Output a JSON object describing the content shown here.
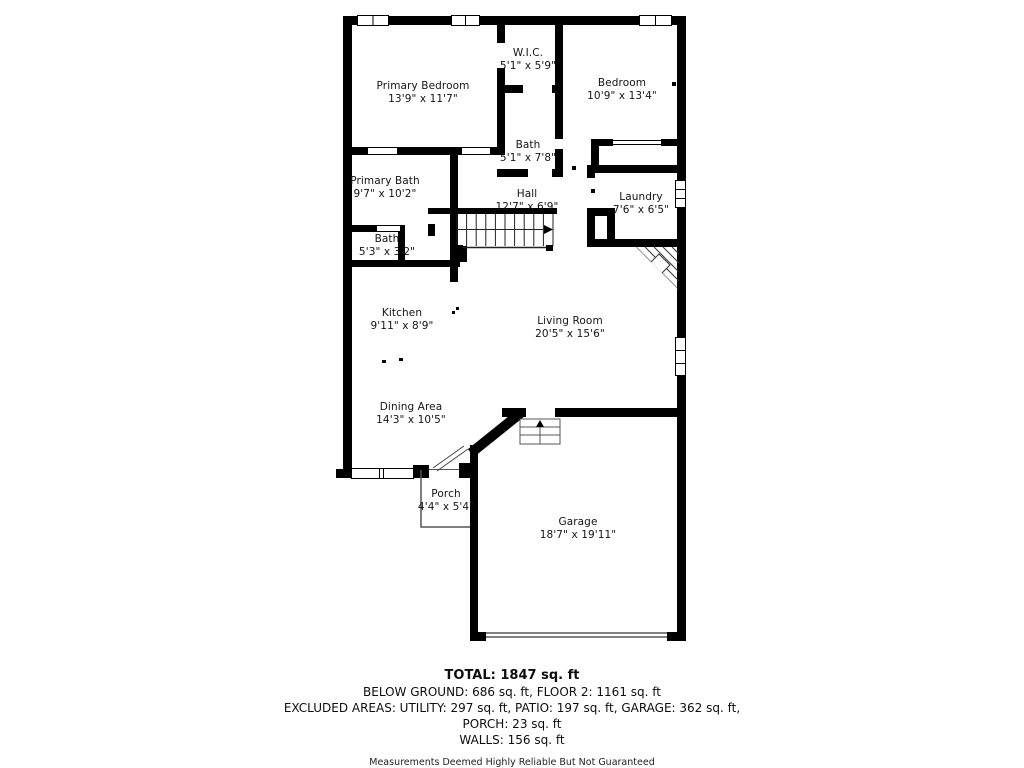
{
  "plan": {
    "rooms": [
      {
        "id": "primary-bedroom",
        "name": "Primary Bedroom",
        "dims": "13'9\" x 11'7\""
      },
      {
        "id": "wic",
        "name": "W.I.C.",
        "dims": "5'1\" x 5'9\""
      },
      {
        "id": "bedroom",
        "name": "Bedroom",
        "dims": "10'9\" x 13'4\""
      },
      {
        "id": "bath-upper",
        "name": "Bath",
        "dims": "5'1\" x 7'8\""
      },
      {
        "id": "primary-bath",
        "name": "Primary Bath",
        "dims": "9'7\" x 10'2\""
      },
      {
        "id": "hall",
        "name": "Hall",
        "dims": "12'7\" x 6'9\""
      },
      {
        "id": "laundry",
        "name": "Laundry",
        "dims": "7'6\" x 6'5\""
      },
      {
        "id": "bath-lower",
        "name": "Bath",
        "dims": "5'3\" x 3'2\""
      },
      {
        "id": "kitchen",
        "name": "Kitchen",
        "dims": "9'11\" x 8'9\""
      },
      {
        "id": "living-room",
        "name": "Living Room",
        "dims": "20'5\" x 15'6\""
      },
      {
        "id": "dining-area",
        "name": "Dining Area",
        "dims": "14'3\" x 10'5\""
      },
      {
        "id": "porch",
        "name": "Porch",
        "dims": "4'4\" x 5'4\""
      },
      {
        "id": "garage",
        "name": "Garage",
        "dims": "18'7\" x 19'11\""
      }
    ]
  },
  "summary": {
    "total": "TOTAL: 1847 sq. ft",
    "below_ground": "BELOW GROUND: 686 sq. ft, FLOOR 2: 1161 sq. ft",
    "excluded": "EXCLUDED AREAS: UTILITY: 297 sq. ft, PATIO: 197 sq. ft, GARAGE: 362 sq. ft,",
    "porch": "PORCH: 23 sq. ft",
    "walls": "WALLS: 156 sq. ft"
  },
  "disclaimer": "Measurements Deemed Highly Reliable But Not Guaranteed",
  "colors": {
    "wall": "#000000",
    "background": "#ffffff",
    "thin_line": "#555555"
  }
}
